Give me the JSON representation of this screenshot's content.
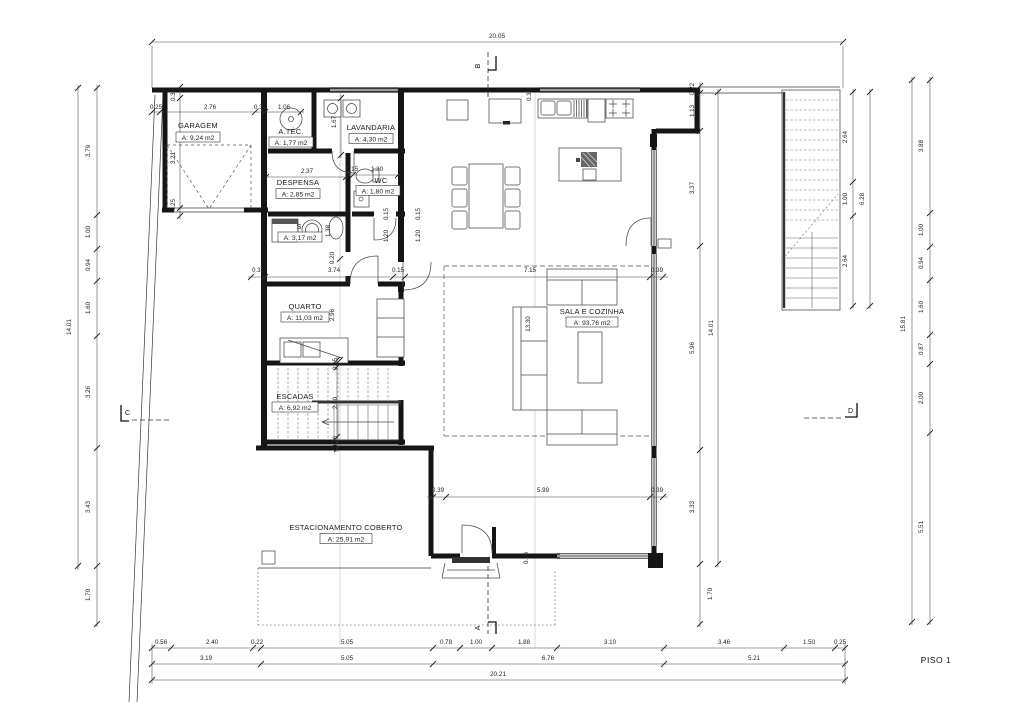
{
  "sheet": {
    "title": "PISO 1"
  },
  "rooms": [
    {
      "name": "GARAGEM",
      "area": "A: 9,24 m2"
    },
    {
      "name": "A.TÉC.",
      "area": "A: 1,77 m2"
    },
    {
      "name": "LAVANDARIA",
      "area": "A: 4,30 m2"
    },
    {
      "name": "DESPENSA",
      "area": "A: 2,85 m2"
    },
    {
      "name": "WC",
      "area": "A: 1,80 m2"
    },
    {
      "name": "S",
      "area": "A: 3,17 m2"
    },
    {
      "name": "QUARTO",
      "area": "A: 11,03 m2"
    },
    {
      "name": "ESCADAS",
      "area": "A: 6,92 m2"
    },
    {
      "name": "SALA E COZINHA",
      "area": "A: 93,76 m2"
    },
    {
      "name": "ESTACIONAMENTO COBERTO",
      "area": "A: 25,91 m2"
    }
  ],
  "sections": {
    "a": "A",
    "b": "B",
    "c": "C",
    "d": "D"
  },
  "dims": {
    "top_total": "20.05",
    "bottom_row1": [
      "0.56",
      "2.40",
      "0.22",
      "5.05",
      "0.78",
      "1.00",
      "1.88",
      "3.10",
      "3.46",
      "1.50",
      "0.25"
    ],
    "bottom_row2": [
      "3.19",
      "5.05",
      "6.76",
      "5.21"
    ],
    "bottom_total": "20.21",
    "left_chain": [
      "3.79",
      "1.00",
      "0.94",
      "1.60",
      "3.26",
      "3.43",
      "1.70"
    ],
    "left_total": "14.01",
    "right_chain": [
      "0.22",
      "1.13",
      "3.37",
      "5.96",
      "3.33",
      "1.70"
    ],
    "right_total": "14.01",
    "stair_chain": [
      "2.64",
      "1.00",
      "2.64"
    ],
    "stair_total": "6.28",
    "far_right_chain": [
      "3.88",
      "1.00",
      "0.94",
      "1.60",
      "0.87",
      "2.00",
      "5.51"
    ],
    "far_right_total": "15.81",
    "interior": [
      "0.25",
      "2.76",
      "0.30",
      "1.06",
      "0.33",
      "3.21",
      "0.25",
      "1.67",
      "2.37",
      "0.15",
      "1.30",
      "0.15",
      "1.20",
      "0.15",
      "1.20",
      "1.38",
      "0.20",
      "0.39",
      "3.74",
      "0.15",
      "7.15",
      "0.39",
      "2.96",
      "13.30",
      "0.15",
      "2.00",
      "0.36",
      "0.39",
      "5.99",
      "0.39",
      "0.33",
      "0.36"
    ]
  }
}
